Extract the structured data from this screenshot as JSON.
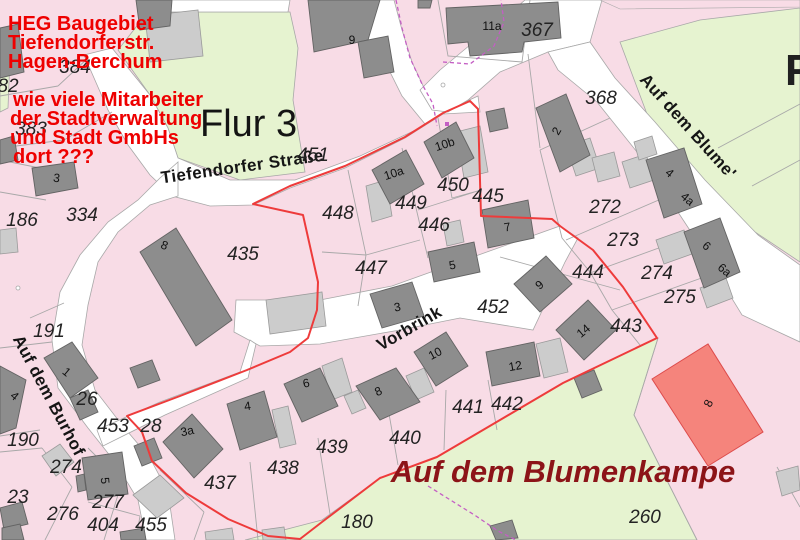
{
  "annotation": {
    "lines": [
      "HEG Baugebiet",
      "Tiefendorferstr.",
      "Hagen-Berchum",
      "wie viele Mitarbeiter",
      "der Stadtverwaltung",
      "und Stadt GmbHs",
      "dort ???"
    ],
    "color": "#ee0000"
  },
  "district_label": "Flur 3",
  "edge_partial_label": "F",
  "street_names": {
    "tiefendorfer": "Tiefendorfer Straße",
    "vorbrink": "Vorbrink",
    "burhof": "Auf dem Burhof",
    "blume": "Auf dem Blume'",
    "blumenkampe": "Auf dem Blumenkampe"
  },
  "colors": {
    "parcel_pink": "#f8dce6",
    "street_white": "#ffffff",
    "green_area": "#e6f3d0",
    "building_dark": "#8d8d8d",
    "building_light": "#cccccc",
    "boundary_gray": "#a8a8a8",
    "development_outline_red": "#ee3b3b",
    "survey_magenta": "#c45ec4",
    "highlight_building_salmon": "#f5847c",
    "bottom_street_dark_red": "#8c1418",
    "annotation_red": "#ee0000"
  },
  "parcel_numbers": [
    {
      "t": "82",
      "x": 8,
      "y": 92
    },
    {
      "t": "384",
      "x": 75,
      "y": 73
    },
    {
      "t": "383",
      "x": 31,
      "y": 135
    },
    {
      "t": "186",
      "x": 22,
      "y": 226
    },
    {
      "t": "334",
      "x": 82,
      "y": 221
    },
    {
      "t": "191",
      "x": 49,
      "y": 337
    },
    {
      "t": "190",
      "x": 23,
      "y": 446
    },
    {
      "t": "26",
      "x": 87,
      "y": 405
    },
    {
      "t": "453",
      "x": 113,
      "y": 432
    },
    {
      "t": "28",
      "x": 151,
      "y": 432
    },
    {
      "t": "274",
      "x": 66,
      "y": 473
    },
    {
      "t": "23",
      "x": 18,
      "y": 503
    },
    {
      "t": "276",
      "x": 63,
      "y": 520
    },
    {
      "t": "277",
      "x": 108,
      "y": 508
    },
    {
      "t": "404",
      "x": 103,
      "y": 531
    },
    {
      "t": "455",
      "x": 151,
      "y": 531
    },
    {
      "t": "437",
      "x": 220,
      "y": 489
    },
    {
      "t": "438",
      "x": 283,
      "y": 474
    },
    {
      "t": "439",
      "x": 332,
      "y": 453
    },
    {
      "t": "440",
      "x": 405,
      "y": 444
    },
    {
      "t": "441",
      "x": 468,
      "y": 413
    },
    {
      "t": "442",
      "x": 507,
      "y": 410
    },
    {
      "t": "180",
      "x": 357,
      "y": 528
    },
    {
      "t": "260",
      "x": 645,
      "y": 523
    },
    {
      "t": "451",
      "x": 313,
      "y": 161
    },
    {
      "t": "448",
      "x": 338,
      "y": 219
    },
    {
      "t": "449",
      "x": 411,
      "y": 209
    },
    {
      "t": "450",
      "x": 453,
      "y": 191
    },
    {
      "t": "445",
      "x": 488,
      "y": 202
    },
    {
      "t": "446",
      "x": 434,
      "y": 231
    },
    {
      "t": "447",
      "x": 371,
      "y": 274
    },
    {
      "t": "452",
      "x": 493,
      "y": 313
    },
    {
      "t": "435",
      "x": 243,
      "y": 260
    },
    {
      "t": "367",
      "x": 537,
      "y": 36
    },
    {
      "t": "368",
      "x": 601,
      "y": 104
    },
    {
      "t": "272",
      "x": 605,
      "y": 213
    },
    {
      "t": "273",
      "x": 623,
      "y": 246
    },
    {
      "t": "274",
      "x": 657,
      "y": 279
    },
    {
      "t": "275",
      "x": 680,
      "y": 303
    },
    {
      "t": "444",
      "x": 588,
      "y": 278
    },
    {
      "t": "443",
      "x": 626,
      "y": 332
    }
  ],
  "building_numbers": [
    {
      "t": "9",
      "x": 352,
      "y": 44,
      "r": 0
    },
    {
      "t": "11a",
      "x": 492,
      "y": 30,
      "r": 0
    },
    {
      "t": "2",
      "x": 560,
      "y": 133,
      "r": -60
    },
    {
      "t": "4",
      "x": 667,
      "y": 176,
      "r": 40
    },
    {
      "t": "4a",
      "x": 685,
      "y": 202,
      "r": 40
    },
    {
      "t": "6",
      "x": 704,
      "y": 249,
      "r": 40
    },
    {
      "t": "6a",
      "x": 722,
      "y": 273,
      "r": 40
    },
    {
      "t": "8",
      "x": 163,
      "y": 249,
      "r": 22
    },
    {
      "t": "3",
      "x": 56,
      "y": 182,
      "r": 8
    },
    {
      "t": "1",
      "x": 64,
      "y": 375,
      "r": 40
    },
    {
      "t": "4",
      "x": 12,
      "y": 399,
      "r": 40
    },
    {
      "t": "5",
      "x": 101,
      "y": 481,
      "r": 85
    },
    {
      "t": "3a",
      "x": 188,
      "y": 435,
      "r": -12
    },
    {
      "t": "4",
      "x": 248,
      "y": 410,
      "r": -8
    },
    {
      "t": "6",
      "x": 307,
      "y": 387,
      "r": -12
    },
    {
      "t": "8",
      "x": 380,
      "y": 395,
      "r": -25
    },
    {
      "t": "10",
      "x": 437,
      "y": 357,
      "r": -28
    },
    {
      "t": "12",
      "x": 516,
      "y": 370,
      "r": -10
    },
    {
      "t": "14",
      "x": 586,
      "y": 334,
      "r": -40
    },
    {
      "t": "9",
      "x": 542,
      "y": 288,
      "r": -40
    },
    {
      "t": "7",
      "x": 508,
      "y": 231,
      "r": -10
    },
    {
      "t": "5",
      "x": 453,
      "y": 269,
      "r": -10
    },
    {
      "t": "3",
      "x": 398,
      "y": 311,
      "r": -10
    },
    {
      "t": "10a",
      "x": 395,
      "y": 177,
      "r": -18
    },
    {
      "t": "10b",
      "x": 446,
      "y": 148,
      "r": -18
    },
    {
      "t": "8",
      "x": 712,
      "y": 405,
      "r": -65
    }
  ]
}
